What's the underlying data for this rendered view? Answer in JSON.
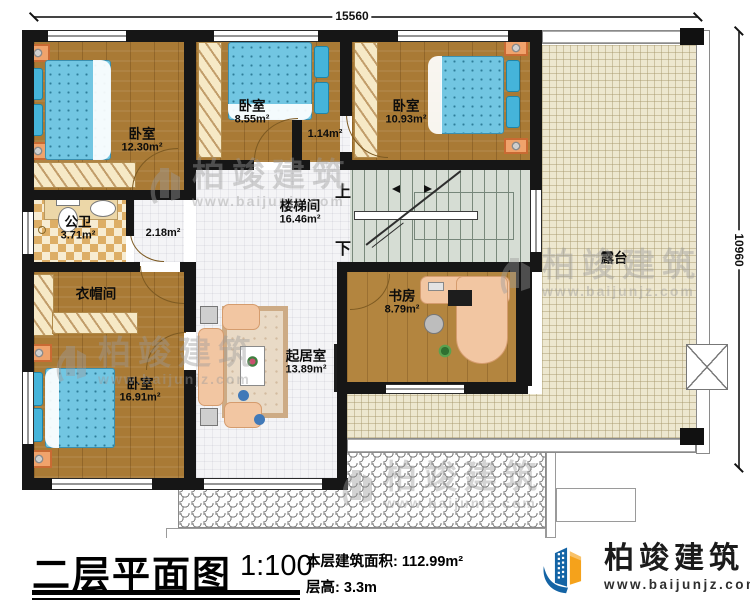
{
  "dimensions": {
    "top": "15560",
    "right": "10960"
  },
  "rooms": [
    {
      "id": "bedroom-top-left",
      "name": "卧室",
      "area": "12.30m²"
    },
    {
      "id": "bedroom-top-mid",
      "name": "卧室",
      "area": "8.55m²"
    },
    {
      "id": "hallway",
      "name": "",
      "area": "1.14m²"
    },
    {
      "id": "bedroom-top-right",
      "name": "卧室",
      "area": "10.93m²"
    },
    {
      "id": "stairwell",
      "name": "楼梯间",
      "area": "16.46m²"
    },
    {
      "id": "bathroom",
      "name": "公卫",
      "area": "3.71m²"
    },
    {
      "id": "corridor",
      "name": "",
      "area": "2.18m²"
    },
    {
      "id": "cloakroom",
      "name": "衣帽间",
      "area": ""
    },
    {
      "id": "bedroom-bottom-left",
      "name": "卧室",
      "area": "16.91m²"
    },
    {
      "id": "living-room",
      "name": "起居室",
      "area": "13.89m²"
    },
    {
      "id": "study",
      "name": "书房",
      "area": "8.79m²"
    },
    {
      "id": "terrace",
      "name": "露台",
      "area": ""
    }
  ],
  "stairs": {
    "up": "上",
    "down": "下"
  },
  "footer": {
    "title": "二层平面图",
    "scale": "1:100",
    "area_label": "本层建筑面积:",
    "area_value": "112.99m²",
    "floor_height_label": "层高:",
    "floor_height_value": "3.3m"
  },
  "logo": {
    "brand": "柏竣建筑",
    "site": "www.baijunjz.com"
  },
  "watermark": {
    "brand": "柏竣建筑",
    "site": "www.baijunjz.com"
  },
  "colors": {
    "wall": "#161616",
    "wood_floor": "#a97a35",
    "bed_blue": "#72c6e2",
    "terrace_beige": "#ede7cf",
    "stairs_green": "#d6ddd4",
    "logo_blue": "#1464a5",
    "logo_orange": "#f5a21b"
  }
}
